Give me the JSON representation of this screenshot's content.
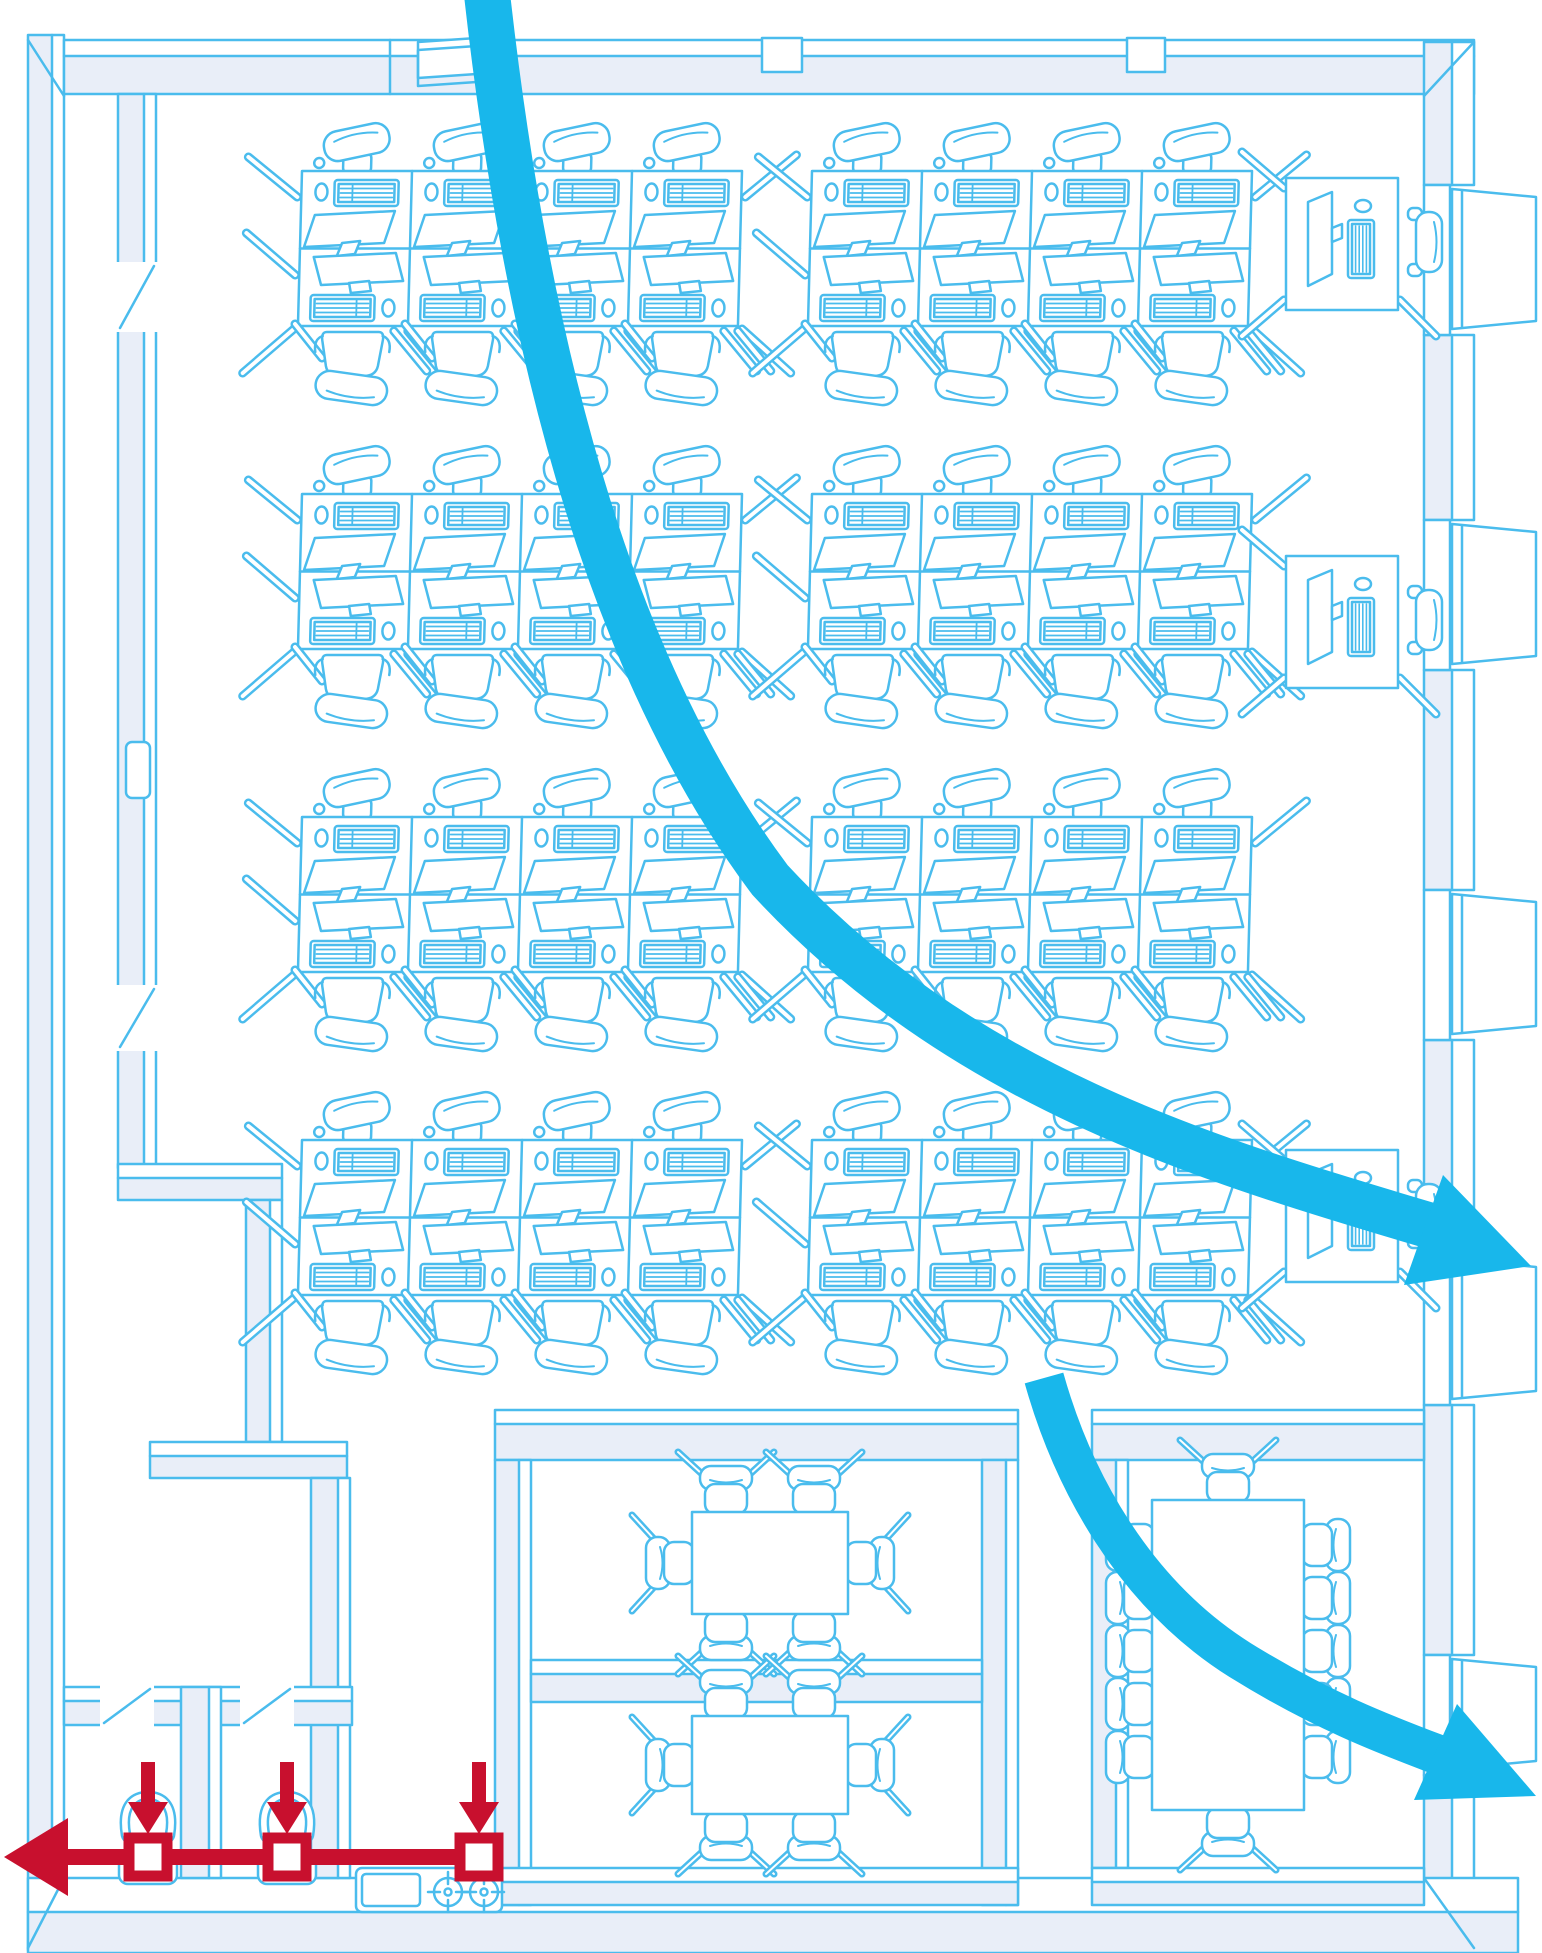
{
  "scene": {
    "width": 1542,
    "height": 1953,
    "background": "#ffffff"
  },
  "palette": {
    "line": "#4abced",
    "wall_fill": "#e9eef8",
    "white": "#ffffff",
    "flow_arrow": "#18b7eb",
    "supply_red": "#c8102e"
  },
  "inventory": {
    "desk_clusters": 8,
    "desks_per_cluster": 8,
    "window_desks": 3,
    "meeting_rooms": 2,
    "seats_per_meeting_room": 6,
    "conference_seats": 12,
    "toilets": 2,
    "supply_nodes": 3,
    "flow_arrows": 2
  },
  "geometry": {
    "outer": {
      "left": {
        "x": 28,
        "y": 35,
        "w": 36,
        "h": 1915
      },
      "top": {
        "x": 64,
        "y": 40,
        "w": 1410,
        "cap_h": 16,
        "band_h": 38
      },
      "right": {
        "x": 1424,
        "w_fill": 28,
        "w_face": 22,
        "y1": 42,
        "y2": 1950
      },
      "bottom": {
        "x": 28,
        "y": 1878,
        "w": 1490,
        "face_h": 34,
        "band_h": 41
      },
      "bevels": [
        [
          28,
          40,
          64,
          96
        ],
        [
          1474,
          42,
          1424,
          96
        ],
        [
          28,
          1948,
          64,
          1878
        ],
        [
          1474,
          1948,
          1424,
          1878
        ]
      ]
    },
    "top_wall_features": {
      "window_piece": [
        [
          418,
          42
        ],
        [
          506,
          36
        ],
        [
          506,
          72
        ],
        [
          418,
          78
        ]
      ],
      "notches": [
        [
          762,
          38,
          40,
          34
        ],
        [
          1127,
          38,
          38,
          34
        ]
      ],
      "step_x": 390
    },
    "right_windows": {
      "bays": [
        [
          185,
          150
        ],
        [
          520,
          150
        ],
        [
          890,
          150
        ],
        [
          1255,
          150
        ],
        [
          1655,
          120
        ]
      ]
    },
    "corridor_wall": {
      "x": 118,
      "y": 94,
      "w": 38,
      "h": 1074,
      "door_gaps": [
        [
          262,
          70
        ],
        [
          985,
          66
        ]
      ],
      "plate": [
        126,
        742,
        24,
        56
      ]
    },
    "partitions": [
      [
        118,
        1164,
        164,
        36,
        "h"
      ],
      [
        246,
        1200,
        36,
        242,
        "v"
      ],
      [
        150,
        1442,
        197,
        36,
        "h"
      ],
      [
        311,
        1478,
        39,
        400,
        "v"
      ]
    ],
    "clusters": [
      [
        302,
        171
      ],
      [
        812,
        171
      ],
      [
        302,
        494
      ],
      [
        812,
        494
      ],
      [
        302,
        817
      ],
      [
        812,
        817
      ],
      [
        302,
        1140
      ],
      [
        812,
        1140
      ]
    ],
    "wall_desks": [
      [
        1286,
        178
      ],
      [
        1286,
        556
      ],
      [
        1286,
        1150
      ]
    ],
    "meeting_block": {
      "top": [
        495,
        1410,
        523,
        50
      ],
      "left": [
        495,
        1460,
        36,
        445
      ],
      "right": [
        982,
        1460,
        36,
        445
      ],
      "mid": [
        531,
        1660,
        451,
        42
      ],
      "bottom": [
        495,
        1868,
        523,
        37
      ],
      "rooms": [
        {
          "table": [
            692,
            1512,
            156,
            102
          ],
          "chairs": [
            [
              726,
              1512,
              0
            ],
            [
              814,
              1512,
              0
            ],
            [
              726,
              1614,
              180
            ],
            [
              814,
              1614,
              180
            ],
            [
              692,
              1563,
              -90
            ],
            [
              848,
              1563,
              90
            ]
          ]
        },
        {
          "table": [
            692,
            1716,
            156,
            98
          ],
          "chairs": [
            [
              726,
              1716,
              0
            ],
            [
              814,
              1716,
              0
            ],
            [
              726,
              1814,
              180
            ],
            [
              814,
              1814,
              180
            ],
            [
              692,
              1765,
              -90
            ],
            [
              848,
              1765,
              90
            ]
          ]
        }
      ]
    },
    "conference": {
      "top": [
        1092,
        1410,
        332,
        50
      ],
      "left": [
        1092,
        1460,
        36,
        408
      ],
      "bottom": [
        1092,
        1868,
        332,
        37
      ],
      "table": [
        1152,
        1500,
        152,
        310
      ],
      "chairs": [
        [
          1228,
          1500,
          0
        ],
        [
          1228,
          1810,
          180
        ],
        [
          1152,
          1545,
          -90
        ],
        [
          1152,
          1598,
          -90
        ],
        [
          1152,
          1651,
          -90
        ],
        [
          1152,
          1704,
          -90
        ],
        [
          1152,
          1757,
          -90
        ],
        [
          1304,
          1545,
          90
        ],
        [
          1304,
          1598,
          90
        ],
        [
          1304,
          1651,
          90
        ],
        [
          1304,
          1704,
          90
        ],
        [
          1304,
          1757,
          90
        ]
      ]
    },
    "restrooms": {
      "top_band": [
        64,
        1687,
        288,
        38
      ],
      "door_gaps": [
        [
          100,
          1685,
          54,
          42
        ],
        [
          240,
          1685,
          54,
          42
        ]
      ],
      "divider": [
        181,
        1687,
        40,
        191
      ],
      "toilets": [
        [
          148,
          1794
        ],
        [
          287,
          1794
        ]
      ]
    },
    "kitchenette": {
      "counter": [
        356,
        1868,
        146,
        44
      ],
      "sink": [
        362,
        1874,
        58,
        32
      ],
      "burners": [
        [
          448,
          1892
        ],
        [
          484,
          1892
        ]
      ]
    },
    "supply": {
      "y": 1857,
      "thickness": 16,
      "x_end": 66,
      "head": [
        [
          4,
          1857
        ],
        [
          68,
          1818
        ],
        [
          68,
          1896
        ]
      ],
      "nodes": [
        148,
        287,
        479
      ],
      "node_size": 38,
      "node_stroke": 11,
      "drop_arrows": {
        "shaft_w": 14,
        "shaft_top": 1762,
        "shaft_h": 40,
        "head_half": 20,
        "tip_y": 1834
      }
    },
    "flow_arrows": [
      {
        "path": "M 487 -6 C 530 380 620 680 770 880 C 960 1085 1200 1158 1438 1228",
        "width": 46,
        "head": [
          [
            1531,
            1266
          ],
          [
            1404,
            1285
          ],
          [
            1443,
            1175
          ]
        ]
      },
      {
        "path": "M 1044 1378 C 1072 1478 1132 1592 1240 1660 C 1330 1716 1400 1740 1452 1760",
        "width": 40,
        "head": [
          [
            1536,
            1796
          ],
          [
            1414,
            1800
          ],
          [
            1457,
            1704
          ]
        ]
      }
    ]
  }
}
